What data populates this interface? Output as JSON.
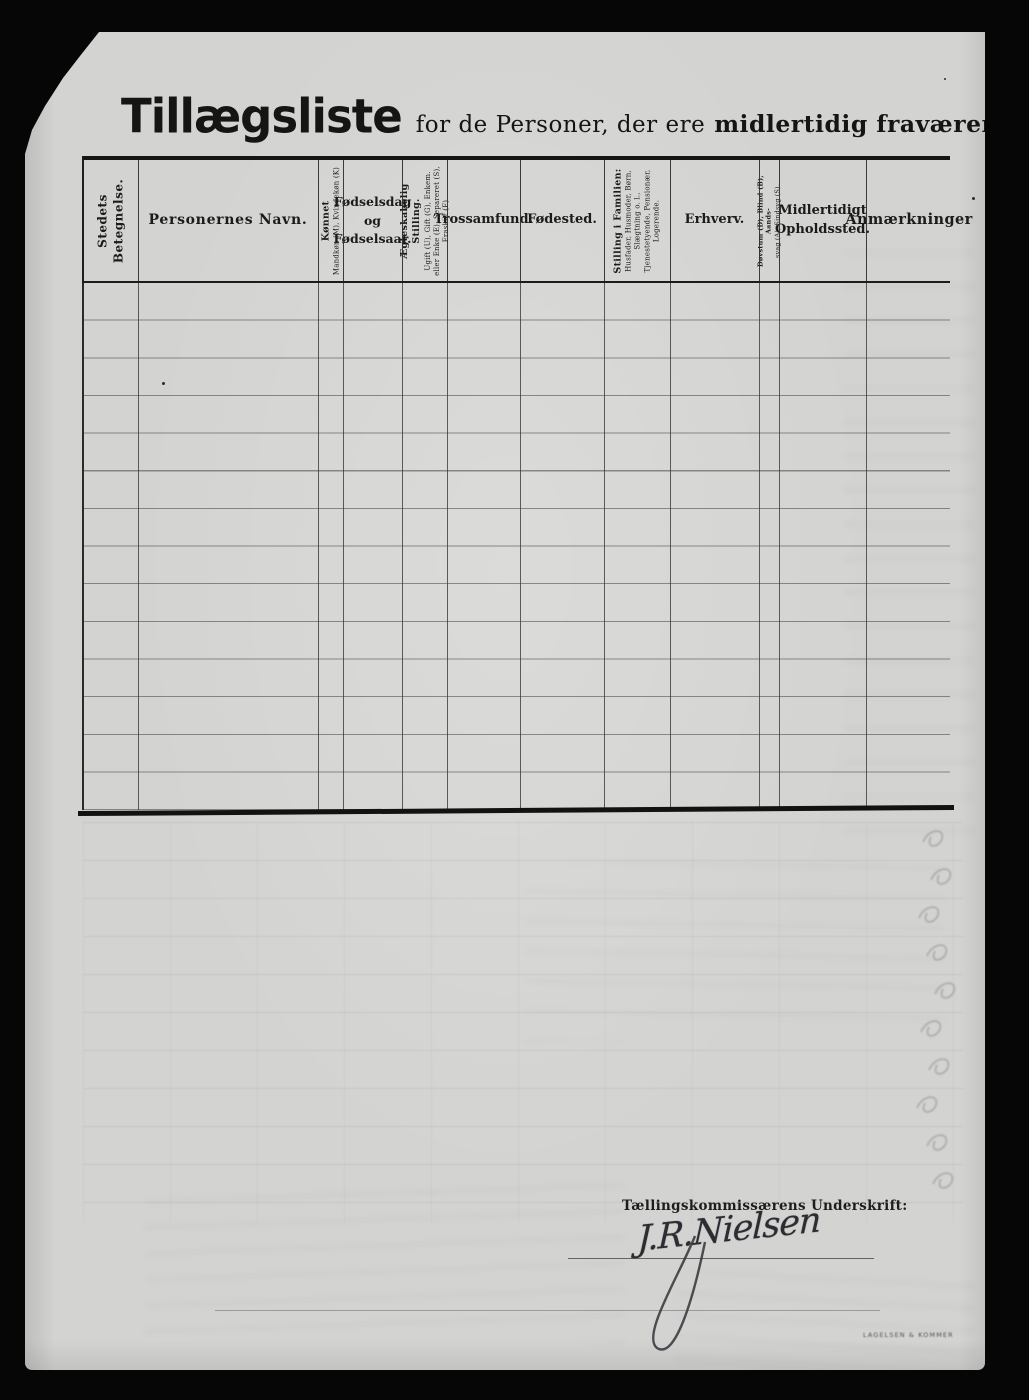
{
  "document": {
    "title": "Tillægsliste",
    "subtitle_regular": "for de Personer, der ere",
    "subtitle_bold": "midlertidig fraværende."
  },
  "table": {
    "columns": [
      {
        "id": "stedets-betegnelse",
        "lines": [
          "Stedets Betegnelse."
        ]
      },
      {
        "id": "personernes-navn",
        "lines": [
          "Personernes Navn."
        ]
      },
      {
        "id": "koennet",
        "lines": [
          "Kønnet",
          "Mandkøn (M), Kvindekøn (K)"
        ]
      },
      {
        "id": "foedselsdag",
        "lines": [
          "Fødselsdag",
          "og",
          "Fødselsaar."
        ]
      },
      {
        "id": "aegteskabelig-stilling",
        "lines": [
          "Ægteskabelig Stilling.",
          "Ugift (U), Gift (G), Enkem.",
          "eller Enke (E), Separeret (S),",
          "Fraskilt (F)"
        ]
      },
      {
        "id": "trossamfund",
        "lines": [
          "Trossamfund."
        ]
      },
      {
        "id": "foedested",
        "lines": [
          "Fødested."
        ]
      },
      {
        "id": "stilling-i-familien",
        "lines": [
          "Stilling i Familien:",
          "Husfader, Husmoder, Børn,",
          "Slægtning o. l.,",
          "Tjenestetyende, Pensionær,",
          "Logerende."
        ]
      },
      {
        "id": "erhverv",
        "lines": [
          "Erhverv."
        ]
      },
      {
        "id": "doevstum-blind",
        "lines": [
          "Døvstum (D), Blind (B), Aands-",
          "svag (A), Sindsyg (S)."
        ]
      },
      {
        "id": "midlertidigt-opholdssted",
        "lines": [
          "Midlertidigt",
          "Opholdssted."
        ]
      },
      {
        "id": "anmaerkninger",
        "lines": [
          "Anmærkninger"
        ]
      }
    ],
    "empty_row_count": 14
  },
  "footer": {
    "signature_label": "Tællingskommissærens Underskrift:",
    "signature": "J.R.Nielsen",
    "printer_mark": "LAGELSEN & KOMMER"
  }
}
